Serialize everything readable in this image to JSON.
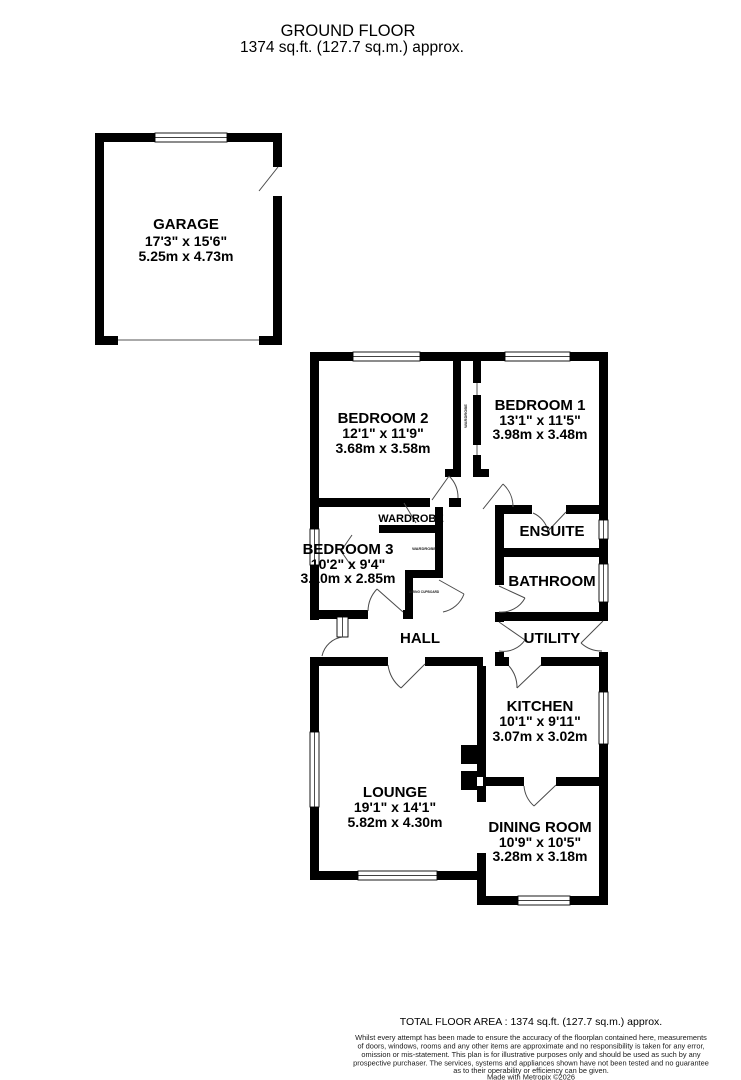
{
  "title": {
    "line1": "GROUND FLOOR",
    "line2": "1374 sq.ft. (127.7 sq.m.) approx."
  },
  "rooms": {
    "garage": {
      "name": "GARAGE",
      "imperial": "17'3\" x 15'6\"",
      "metric": "5.25m x 4.73m"
    },
    "bedroom2": {
      "name": "BEDROOM 2",
      "imperial": "12'1\" x 11'9\"",
      "metric": "3.68m x 3.58m"
    },
    "bedroom1": {
      "name": "BEDROOM 1",
      "imperial": "13'1\" x 11'5\"",
      "metric": "3.98m x 3.48m"
    },
    "bedroom3": {
      "name": "BEDROOM 3",
      "imperial": "10'2\" x 9'4\"",
      "metric": "3.10m x 2.85m"
    },
    "kitchen": {
      "name": "KITCHEN",
      "imperial": "10'1\" x 9'11\"",
      "metric": "3.07m x 3.02m"
    },
    "lounge": {
      "name": "LOUNGE",
      "imperial": "19'1\" x 14'1\"",
      "metric": "5.82m x 4.30m"
    },
    "dining": {
      "name": "DINING ROOM",
      "imperial": "10'9\" x 10'5\"",
      "metric": "3.28m x 3.18m"
    },
    "hall": {
      "name": "HALL"
    },
    "utility": {
      "name": "UTILITY"
    },
    "ensuite": {
      "name": "ENSUITE"
    },
    "bathroom": {
      "name": "BATHROOM"
    },
    "wardrobe": {
      "name": "WARDROBE"
    },
    "wardrobe_channel": {
      "name": "WARDROBE"
    },
    "wardrobe_small": {
      "name": "WARDROBE"
    },
    "airing_cupboard": {
      "name": "AIRING CUPBOARD"
    }
  },
  "footer": {
    "total": "TOTAL FLOOR AREA : 1374 sq.ft. (127.7 sq.m.) approx.",
    "disclaimer_lines": [
      "Whilst every attempt has been made to ensure the accuracy of the floorplan contained here, measurements",
      "of doors, windows, rooms and any other items are approximate and no responsibility is taken for any error,",
      "omission or mis-statement. This plan is for illustrative purposes only and should be used as such by any",
      "prospective purchaser. The services, systems and appliances shown have not been tested and no guarantee",
      "as to their operability or efficiency can be given.",
      "Made with Metropix ©2026"
    ]
  },
  "colors": {
    "wall": "#000000",
    "background": "#ffffff",
    "door_arc": "#4a4a4a"
  }
}
